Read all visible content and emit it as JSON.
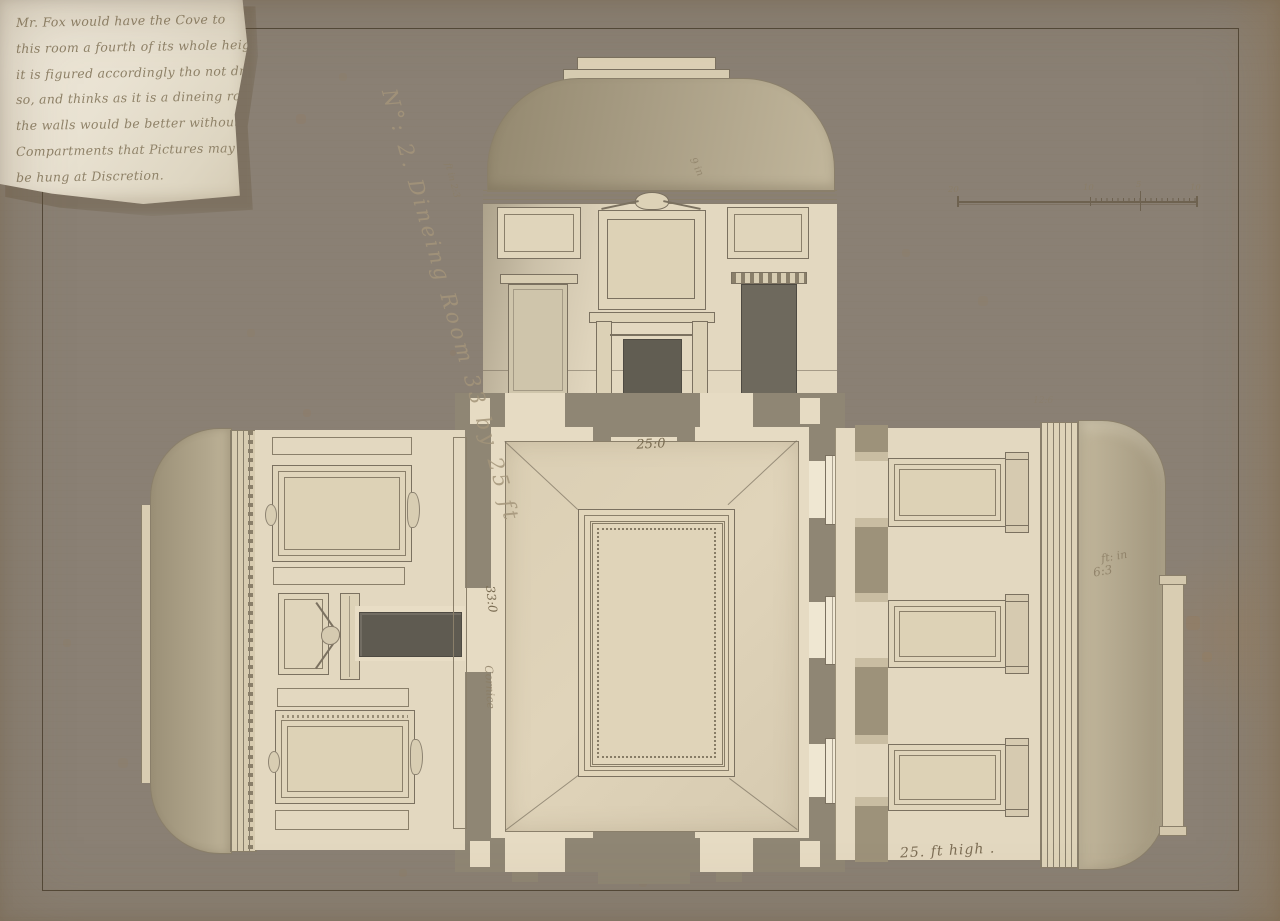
{
  "note": {
    "lines": [
      "Mr. Fox would have the Cove to",
      "this room a fourth of its whole height",
      "it is figured accordingly tho not drawn",
      "so, and thinks as it is a dineing room",
      "the walls would be better without",
      "Compartments that Pictures may",
      "be hung at Discretion."
    ]
  },
  "title": {
    "inscription": "N°: 2. Dineing Room 33 by 25 ft"
  },
  "scale_bar": {
    "labels": [
      "20",
      "10",
      "5",
      "10"
    ]
  },
  "plan": {
    "width_dim": "25:0",
    "length_dim": "33:0",
    "cornice_label": "Cornice"
  },
  "elevations": {
    "chimney_wall": {
      "left_dim": "ft in 2:3",
      "cove_dim": "9 in"
    },
    "window_wall": {
      "pier_dim_line1": "ft: in",
      "pier_dim_line2": "6:3",
      "faint_dim": "12:6"
    },
    "height_note": "25. ft high ."
  },
  "colors": {
    "paper": "#e4d7bf",
    "note_paper": "#e9e2d2",
    "wall_poche": "#8f8674",
    "wash": "#aba188",
    "ink": "#7b7160",
    "dark_opening": "#615d52",
    "handwriting": "#8f8268"
  }
}
